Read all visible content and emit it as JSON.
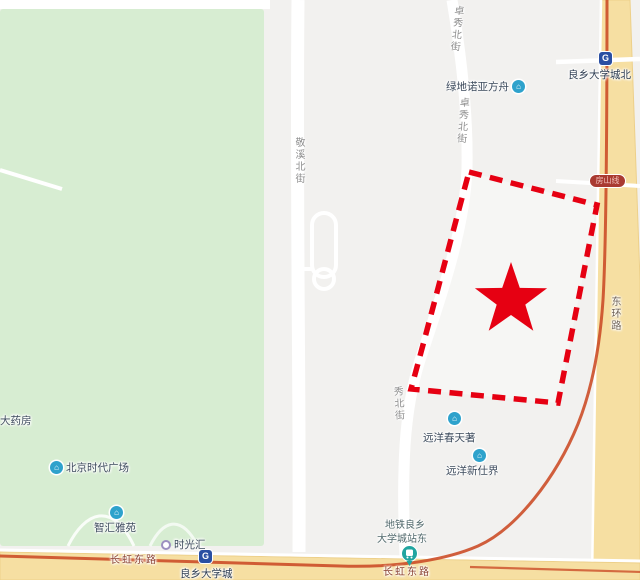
{
  "map": {
    "streets": {
      "zhuoxiu_top": "卓秀北街",
      "zhuoxiu_mid": "卓秀北街",
      "jingxi": "敬溪北街",
      "xiu_lower": "秀北街",
      "donghuan": "东环路",
      "changhong_left": "长虹东路",
      "changhong_right": "长虹东路"
    },
    "pois": {
      "pharmacy": "大药房",
      "greenland": "绿地诺亚方舟",
      "times_square": "北京时代广场",
      "zhihui": "智汇雅苑",
      "shiguanghui": "时光汇",
      "spring_villa": "远洋春天著",
      "new_world": "远洋新仕界",
      "bus_stop_line1": "地铁良乡",
      "bus_stop_line2": "大学城站东"
    },
    "stations": {
      "north": "良乡大学城北",
      "main": "良乡大学城"
    },
    "badge": {
      "fangshan_line": "房山线"
    },
    "icons": {
      "metro_logo_glyph": "G",
      "poi_building_glyph": "⌂"
    },
    "colors": {
      "highlight_red": "#e60012",
      "park_green": "#d7edd2",
      "road_yellow": "#f6dfa2",
      "metro_line_orange": "#cc4e28",
      "poi_icon_blue": "#2ea2cc",
      "metro_icon_blue": "#2a4fa2",
      "transit_teal": "#21a5a0",
      "badge_red": "#a93a31",
      "background_gray": "#f2f1ef"
    }
  }
}
